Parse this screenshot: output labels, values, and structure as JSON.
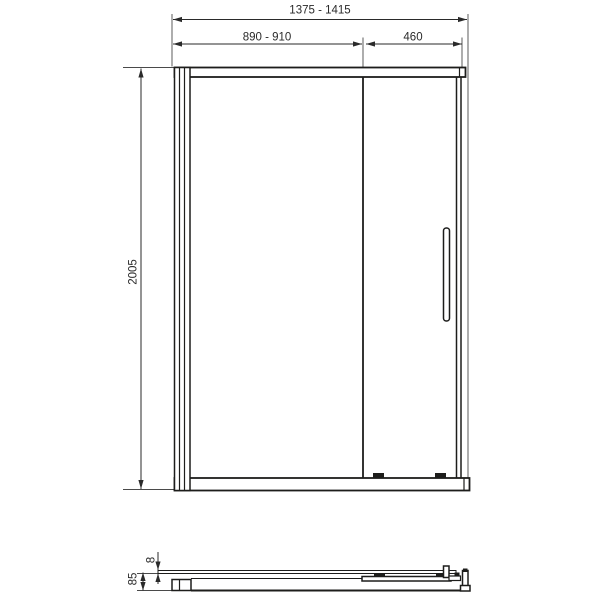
{
  "page": {
    "background": "#ffffff",
    "line_color": "#1d1d1b",
    "text_color": "#2a2a2a"
  },
  "front_view": {
    "dim_overall_width": "1375 - 1415",
    "dim_sliding_door_width": "890 - 910",
    "dim_fixed_panel_width": "460",
    "dim_height": "2005"
  },
  "section_view": {
    "dim_glass_thickness": "8",
    "dim_profile_depth": "85"
  }
}
